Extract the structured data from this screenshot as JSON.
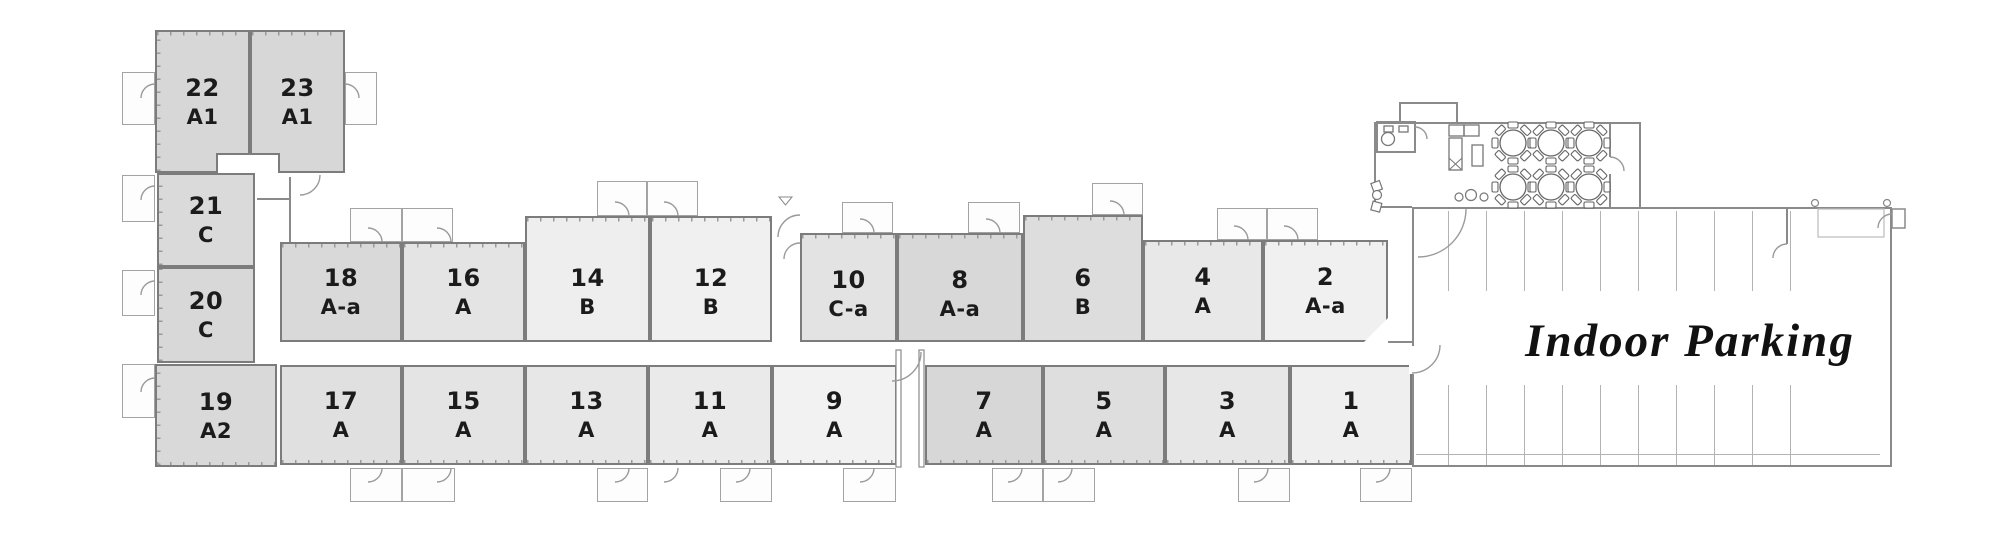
{
  "plan": {
    "type": "residential-floor-plan-with-parking",
    "left_wing": {
      "units": [
        {
          "number": "22",
          "type": "A1"
        },
        {
          "number": "23",
          "type": "A1"
        },
        {
          "number": "21",
          "type": "C"
        },
        {
          "number": "20",
          "type": "C"
        },
        {
          "number": "19",
          "type": "A2"
        }
      ]
    },
    "top_row": {
      "units": [
        {
          "number": "18",
          "type": "A-a"
        },
        {
          "number": "16",
          "type": "A"
        },
        {
          "number": "14",
          "type": "B"
        },
        {
          "number": "12",
          "type": "B"
        },
        {
          "number": "10",
          "type": "C-a"
        },
        {
          "number": "8",
          "type": "A-a"
        },
        {
          "number": "6",
          "type": "B"
        },
        {
          "number": "4",
          "type": "A"
        },
        {
          "number": "2",
          "type": "A-a"
        }
      ]
    },
    "bottom_row": {
      "units": [
        {
          "number": "17",
          "type": "A"
        },
        {
          "number": "15",
          "type": "A"
        },
        {
          "number": "13",
          "type": "A"
        },
        {
          "number": "11",
          "type": "A"
        },
        {
          "number": "9",
          "type": "A"
        },
        {
          "number": "7",
          "type": "A"
        },
        {
          "number": "5",
          "type": "A"
        },
        {
          "number": "3",
          "type": "A"
        },
        {
          "number": "1",
          "type": "A"
        }
      ]
    },
    "parking": {
      "label": "Indoor Parking"
    },
    "amenity_room": {
      "round_table_count": 6
    },
    "colors": {
      "wall": "#7c7c7c",
      "thin_wall": "#9a9a9a",
      "unit_fill_dark": "#d7d7d7",
      "unit_fill_light": "#f2f2f2",
      "background": "#ffffff",
      "label_text": "#1b1b1b"
    }
  }
}
